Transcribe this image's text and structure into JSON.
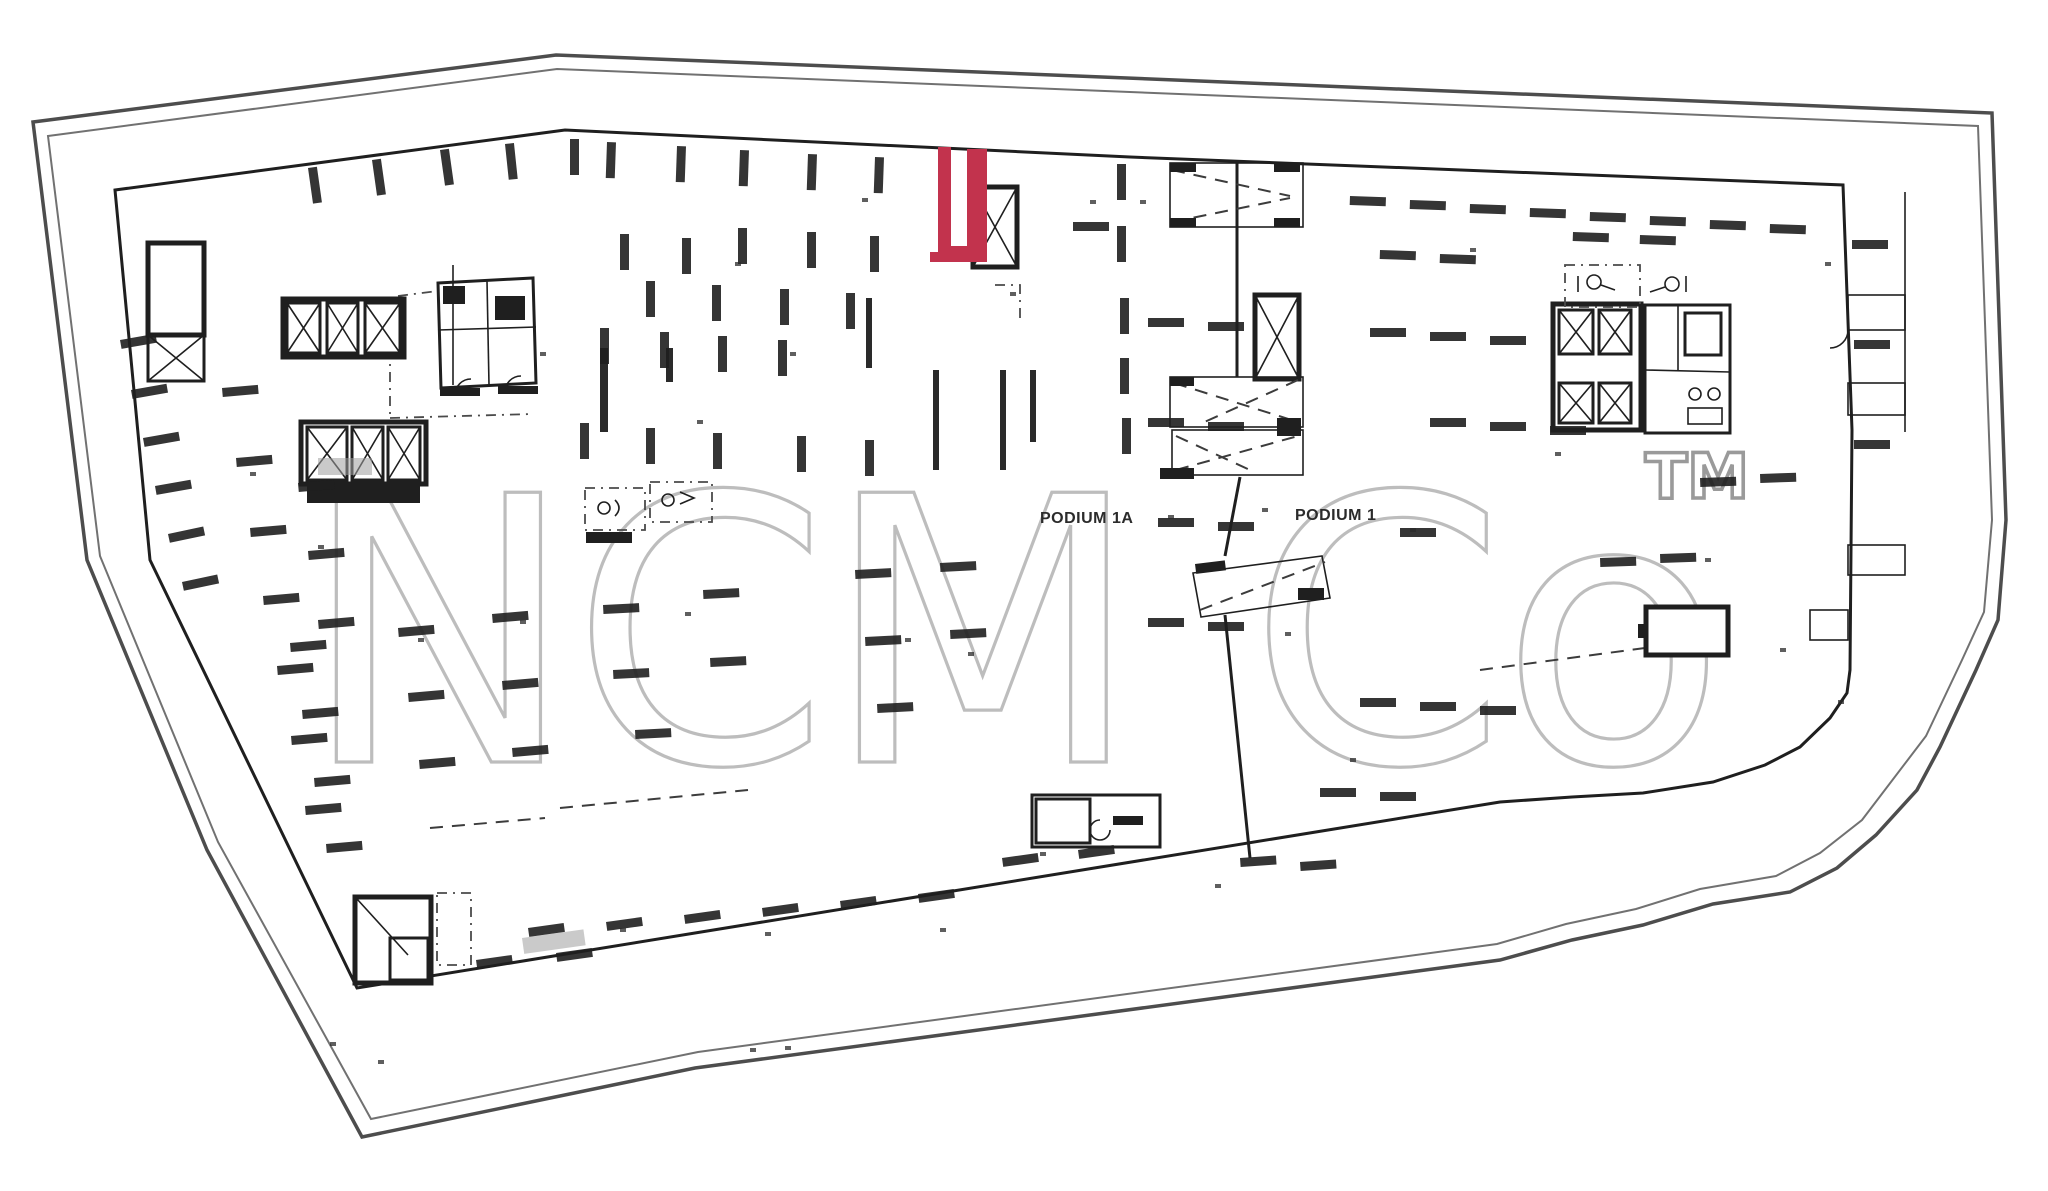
{
  "title": "Podium parking level floor plan (scanned architectural drawing)",
  "watermark": {
    "text": "NCM Co",
    "tm": "TM"
  },
  "labels": {
    "podium_1a": "PODIUM 1A",
    "podium_1": "PODIUM 1"
  },
  "highlight": {
    "label": "highlighted unit outline",
    "color": "#c2334d"
  },
  "colors": {
    "paper": "#ffffff",
    "ink": "#1f1f1f",
    "line": "#4d4d4d",
    "watermark": "#bdbdbd",
    "tm": "#9a9a9a",
    "shade": "#9e9e9e",
    "accent": "#c2334d"
  }
}
